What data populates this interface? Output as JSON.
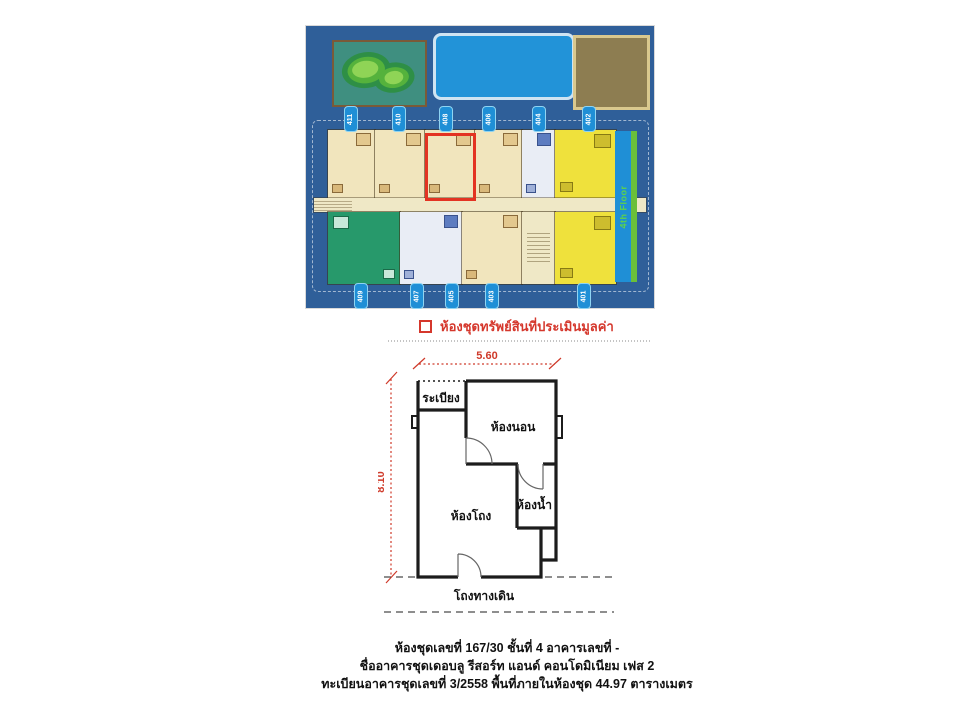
{
  "site_plan": {
    "floor_label": "4th Floor",
    "legend_label": "ห้องชุดทรัพย์สินที่ประเมินมูลค่า",
    "top_units": [
      "411",
      "410",
      "408",
      "406",
      "404",
      "402"
    ],
    "bottom_units": [
      "409",
      "407",
      "405",
      "403",
      "401"
    ]
  },
  "floor_plan": {
    "width_dim": "5.60",
    "height_dim": "8.10",
    "rooms": {
      "balcony": "ระเบียง",
      "bedroom": "ห้องนอน",
      "living": "ห้องโถง",
      "bathroom": "ห้องน้ำ",
      "corridor": "โถงทางเดิน"
    }
  },
  "details": {
    "line1": "ห้องชุดเลขที่ 167/30  ชั้นที่ 4 อาคารเลขที่ -",
    "line2": "ชื่ออาคารชุดเดอบลู รีสอร์ท แอนด์ คอนโดมิเนียม เฟส 2",
    "line3": "ทะเบียนอาคารชุดเลขที่ 3/2558 พื้นที่ภายในห้องชุด 44.97 ตารางเมตร"
  },
  "colors": {
    "page_bg": "#ffffff",
    "plan_bg": "#2f5f99",
    "pool_blue": "#2293d8",
    "badge_blue": "#1f8fd6",
    "amenity_teal": "#3f8f80",
    "green_dark": "#2e8f46",
    "green_mid": "#55b23c",
    "green_light": "#8fd456",
    "brown_fill": "#8d7d51",
    "brown_border": "#d9c88e",
    "walkway": "#efe8c6",
    "unit_cream": "#f1e5bd",
    "unit_yellow": "#efe13c",
    "unit_green": "#27996b",
    "unit_white": "#e9edf5",
    "furn_tan": "#d9b87a",
    "furn_blue": "#5d7cc0",
    "furn_yellow": "#cdbd2e",
    "furn_mint": "#c8e8da",
    "highlight_red": "#e33322",
    "legend_red": "#d5372c",
    "dim_red": "#cf3a2a",
    "wall_black": "#1c1c1c",
    "floorbar_text_green": "#5fd348",
    "bar_green_strip": "#6abf3a"
  }
}
